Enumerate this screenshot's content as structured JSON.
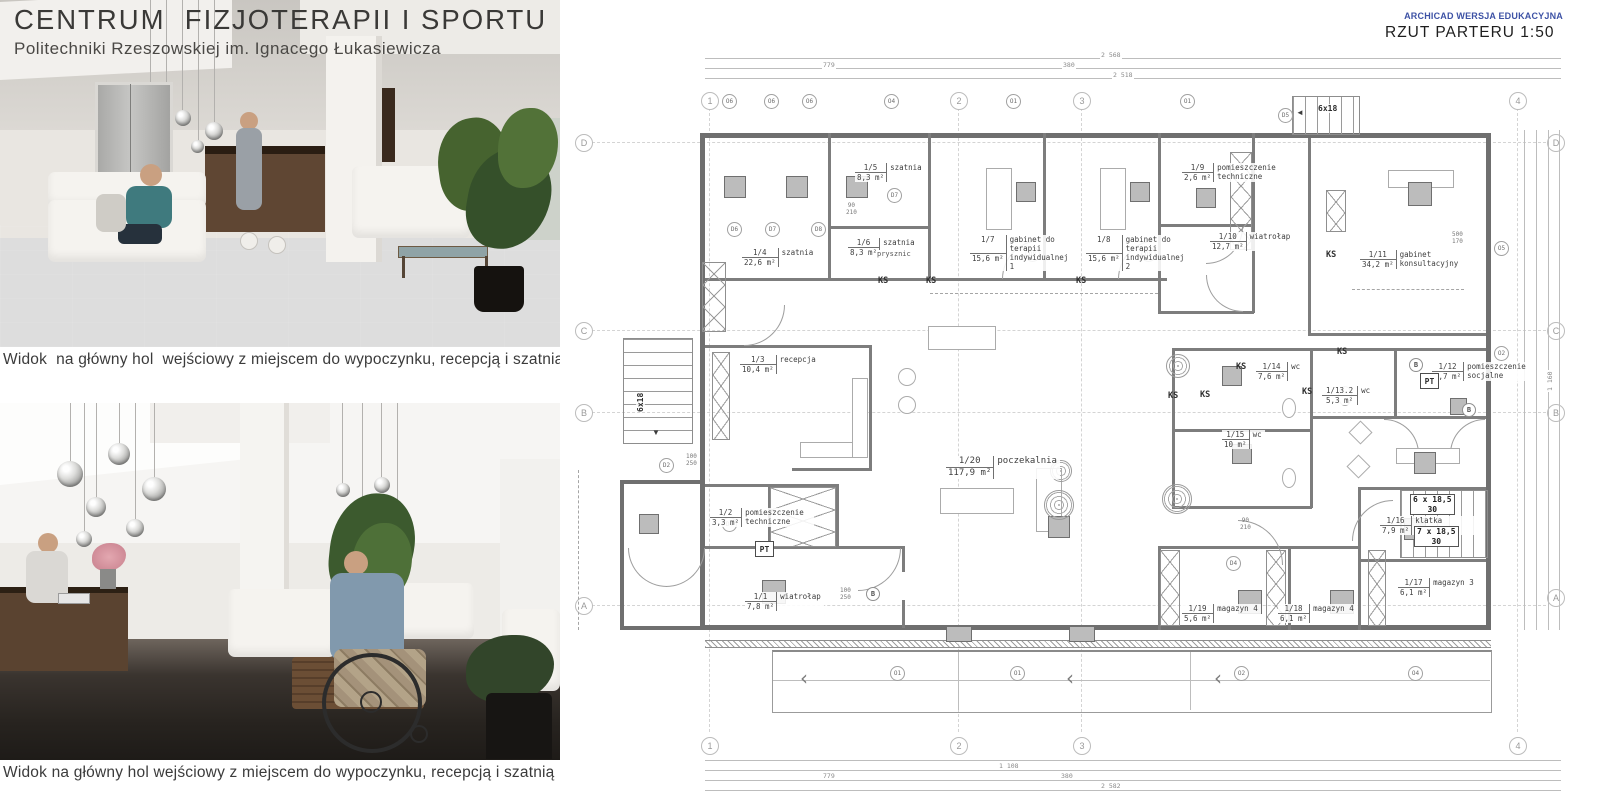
{
  "header": {
    "title": "CENTRUM  FIZJOTERAPII I SPORTU",
    "subtitle": "Politechniki Rzeszowskiej im. Ignacego Łukasiewicza"
  },
  "captions": {
    "top": "Widok  na główny hol  wejściowy z miejscem do wypoczynku, recepcją i szatnią",
    "bottom": "Widok na główny hol wejściowy z miejscem do wypoczynku, recepcją i szatnią"
  },
  "plan": {
    "watermark": "ARCHICAD WERSJA EDUKACYJNA",
    "title": "RZUT PARTERU 1:50",
    "colors": {
      "watermark_blue": "#3d52a5"
    },
    "grid": {
      "columns": [
        "1",
        "2",
        "3",
        "4"
      ],
      "rows": [
        "D",
        "C",
        "B",
        "A"
      ]
    },
    "rooms": [
      {
        "id": "1/1",
        "name": "wiatrołap",
        "area": "7,8 m²"
      },
      {
        "id": "1/2",
        "name": "pomieszczenie techniczne",
        "area": "3,3 m²"
      },
      {
        "id": "1/3",
        "name": "recepcja",
        "area": "10,4 m²"
      },
      {
        "id": "1/4",
        "name": "szatnia",
        "area": "22,6 m²"
      },
      {
        "id": "1/5",
        "name": "szatnia",
        "area": "8,3 m²"
      },
      {
        "id": "1/6",
        "name": "szatnia",
        "area": "8,3 m²"
      },
      {
        "id": "1/7",
        "name": "gabinet do terapii indywidualnej 1",
        "area": "15,6 m²"
      },
      {
        "id": "1/8",
        "name": "gabinet do terapii indywidualnej 2",
        "area": "15,6 m²"
      },
      {
        "id": "1/9",
        "name": "pomieszczenie techniczne",
        "area": "2,6 m²"
      },
      {
        "id": "1/10",
        "name": "wiatrołap",
        "area": "12,7 m²"
      },
      {
        "id": "1/11",
        "name": "gabinet konsultacyjny",
        "area": "34,2 m²"
      },
      {
        "id": "1/12",
        "name": "pomieszczenie socjalne",
        "area": "5,7 m²"
      },
      {
        "id": "1/13.2",
        "name": "wc",
        "area": "5,3 m²"
      },
      {
        "id": "1/14",
        "name": "wc",
        "area": "7,6 m²"
      },
      {
        "id": "1/15",
        "name": "wc",
        "area": "10 m²"
      },
      {
        "id": "1/16",
        "name": "klatka schodowa",
        "area": "7,9 m²"
      },
      {
        "id": "1/17",
        "name": "magazyn 3",
        "area": "6,1 m²"
      },
      {
        "id": "1/18",
        "name": "magazyn 4",
        "area": "6,1 m²"
      },
      {
        "id": "1/19",
        "name": "magazyn 4",
        "area": "5,6 m²"
      },
      {
        "id": "1/20",
        "name": "poczekalnia",
        "area": "117,9 m²"
      }
    ],
    "stairs": {
      "flight": "6x18",
      "runs": [
        {
          "steps": "6 x 18,5",
          "height": "30"
        },
        {
          "steps": "7 x 18,5",
          "height": "30"
        }
      ]
    },
    "markers": {
      "ks": "KS",
      "pt": "PT",
      "b": "B"
    },
    "door_tags": [
      "D2",
      "D4",
      "D5",
      "D6",
      "D7",
      "D8"
    ],
    "window_tags": [
      "O6",
      "O4",
      "O1",
      "O2",
      "O5"
    ],
    "door_dims": [
      {
        "a": "90",
        "b": "210"
      },
      {
        "a": "100",
        "b": "250"
      },
      {
        "a": "500",
        "b": "170"
      }
    ],
    "dims": {
      "top": [
        "779",
        "380",
        "2 568",
        "2 518"
      ],
      "bottom": [
        "779",
        "380",
        "1 108",
        "2 582"
      ],
      "right": [
        "1 160"
      ]
    },
    "labels": {
      "prysznic": "prysznic"
    }
  }
}
